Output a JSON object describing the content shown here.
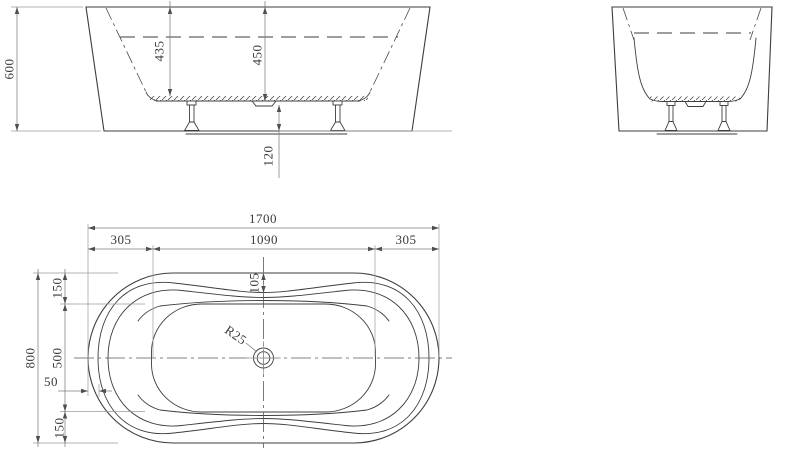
{
  "colors": {
    "background": "#ffffff",
    "line": "#3d3d3d",
    "dimension_line": "#7b7b7b",
    "text": "#3a3a3a"
  },
  "front_view": {
    "overall_height": "600",
    "inner_depth_left": "435",
    "inner_depth_center": "450",
    "floor_clearance": "120"
  },
  "plan_view": {
    "overall_length": "1700",
    "left_end_length": "305",
    "center_length": "1090",
    "right_end_length": "305",
    "rim_width_center": "105",
    "rim_offset_top": "150",
    "inner_width": "500",
    "rim_width_end": "50",
    "rim_offset_bottom": "150",
    "overall_width": "800",
    "drain_radius": "R25"
  }
}
